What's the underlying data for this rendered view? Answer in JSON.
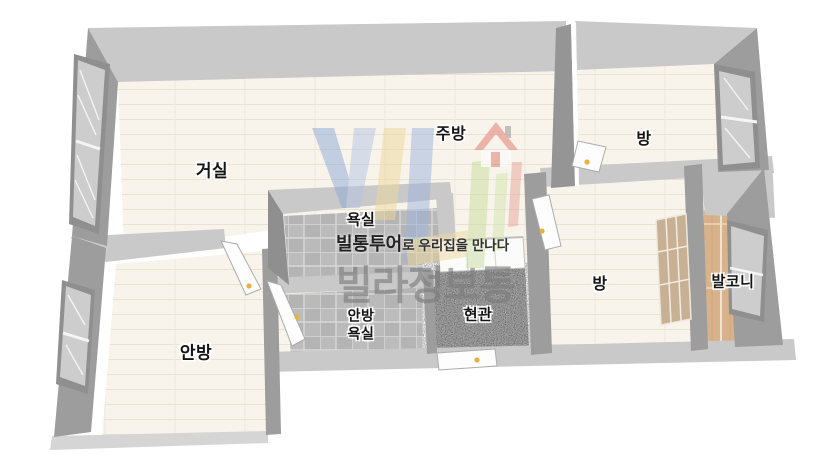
{
  "watermark": {
    "tagline_bold": "빌통투어",
    "tagline_rest": "로 우리집을 만나다",
    "brand": "빌라정보통",
    "logo_icon": "vill-logo-icon",
    "logo_house_icon": "house-icon",
    "logo_colors": {
      "blue": "#8ba7d6",
      "light_blue": "#b3c3e4",
      "yellow": "#edd79b",
      "green": "#c7dd9d",
      "red": "#e2756a"
    }
  },
  "rooms": {
    "living_room": "거실",
    "kitchen": "주방",
    "bedroom_top": "방",
    "bathroom": "욕실",
    "bedroom_mid": "방",
    "balcony": "발코니",
    "master_bedroom": "안방",
    "master_bathroom_line1": "안방",
    "master_bathroom_line2": "욕실",
    "entrance": "현관"
  },
  "palette": {
    "background": "#ffffff",
    "wall_top": "#c9c9c9",
    "wall_face": "#9d9d9d",
    "floor_cream": "#f8f4eb",
    "bath_tile": "#b6b6b6",
    "balcony_wood": "#d8b28b",
    "entrance_floor_gray": "#a7a7a7",
    "door_leaf": "#fdfdfd",
    "door_handle_yellow": "#e7b23c",
    "window_pane": "#cdcdcd"
  }
}
